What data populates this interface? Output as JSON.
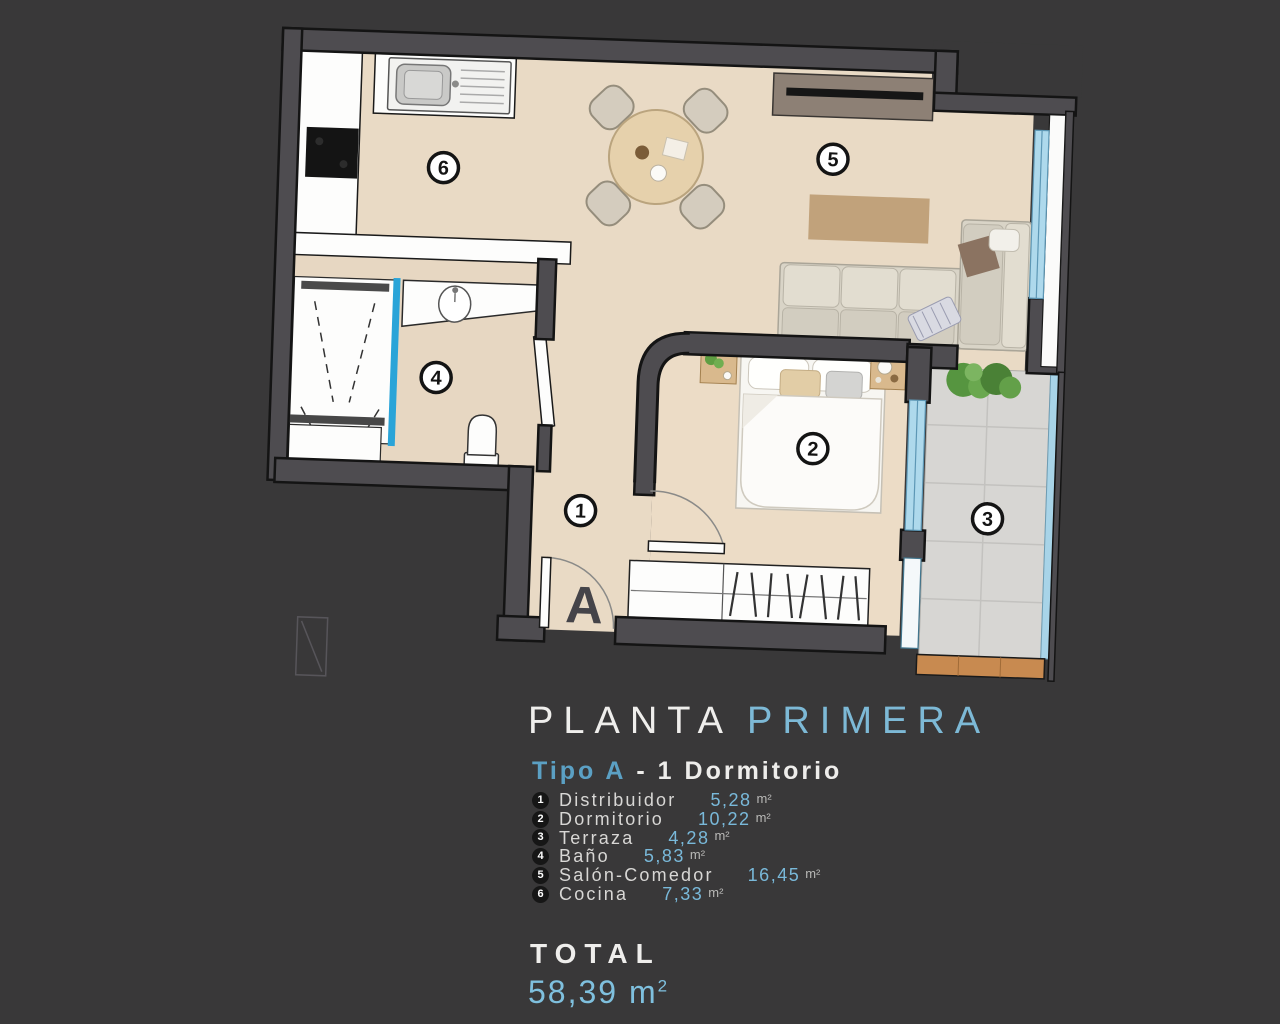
{
  "title": {
    "part1": "PLANTA",
    "part2": "PRIMERA"
  },
  "subtitle": {
    "type_label": "Tipo A",
    "rest": "- 1  Dormitorio"
  },
  "legend": [
    {
      "num": "1",
      "name": "Distribuidor",
      "value": "5,28",
      "unit": "m²"
    },
    {
      "num": "2",
      "name": "Dormitorio",
      "value": "10,22",
      "unit": "m²"
    },
    {
      "num": "3",
      "name": "Terraza",
      "value": "4,28",
      "unit": "m²"
    },
    {
      "num": "4",
      "name": "Baño",
      "value": "5,83",
      "unit": "m²"
    },
    {
      "num": "5",
      "name": "Salón-Comedor",
      "value": "16,45",
      "unit": "m²"
    },
    {
      "num": "6",
      "name": "Cocina",
      "value": "7,33",
      "unit": "m²"
    }
  ],
  "total": {
    "label": "TOTAL",
    "value": "58,39",
    "unit": "m",
    "sup": "2"
  },
  "plan": {
    "entrance_label": "A",
    "badges": {
      "b1": "1",
      "b2": "2",
      "b3": "3",
      "b4": "4",
      "b5": "5",
      "b6": "6"
    }
  },
  "colors": {
    "background": "#393839",
    "wall_gray": "#4e4c50",
    "wall_outline": "#141414",
    "floor_beige": "#e9dac5",
    "glass_blue": "#2aa4d8",
    "window_blue": "#aed9ec",
    "accent_blue": "#7fc0de",
    "terrace_tile": "#d7d6d3",
    "deck_wood": "#c88a50"
  }
}
